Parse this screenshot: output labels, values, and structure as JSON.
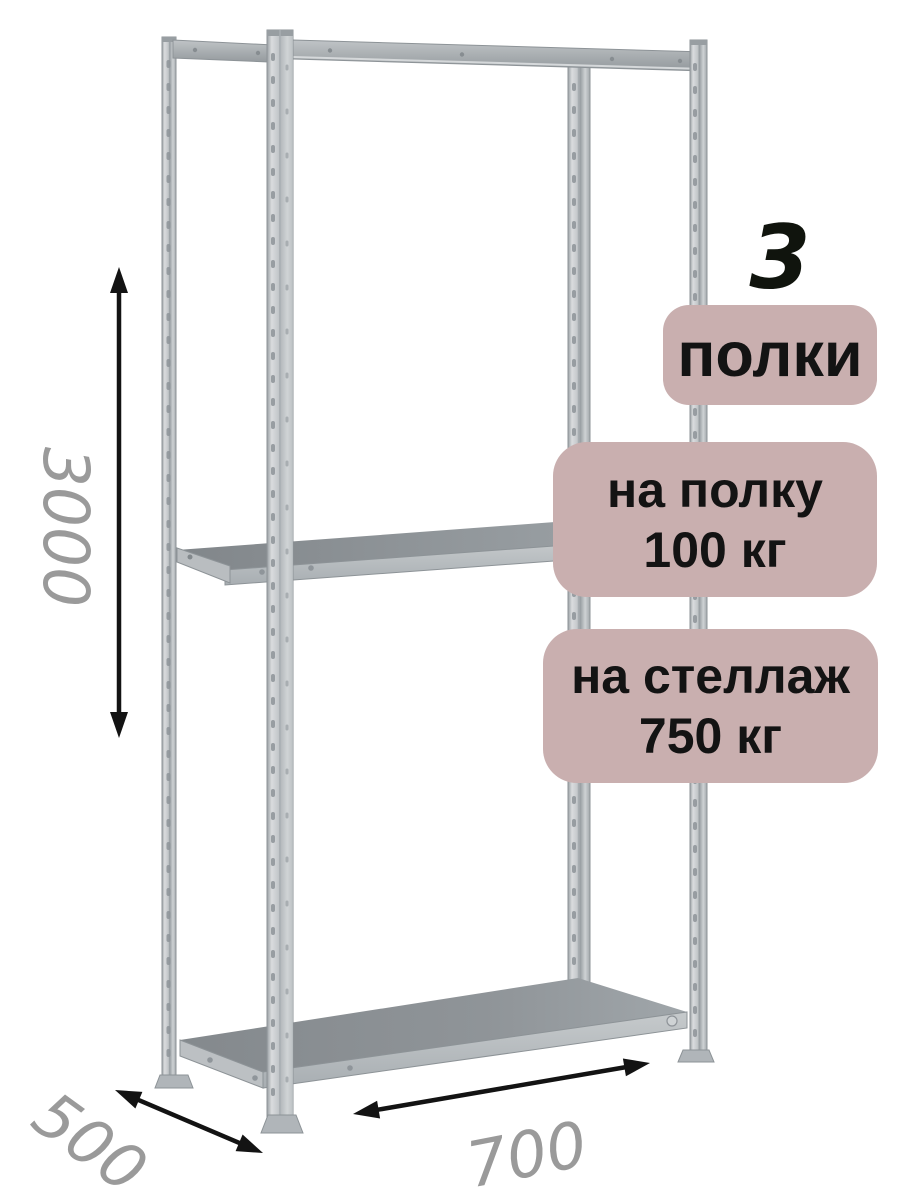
{
  "badges": {
    "count_value": "3",
    "count_label": "полки",
    "per_shelf_line1": "на полку",
    "per_shelf_line2": "100 кг",
    "per_rack_line1": "на стеллаж",
    "per_rack_line2": "750 кг"
  },
  "dimensions": {
    "height_mm": "3000",
    "depth_mm": "500",
    "width_mm": "700"
  },
  "colors": {
    "badge_bg": "#c9afaf",
    "badge_text": "#131313",
    "big_digit": "#10140d",
    "dimension_text": "#9a9a9a",
    "arrow": "#131313",
    "metal_light": "#d2d5d7",
    "metal_mid": "#b6babd",
    "metal_dark": "#8f959a",
    "shelf_surface": "#8a8f93"
  }
}
